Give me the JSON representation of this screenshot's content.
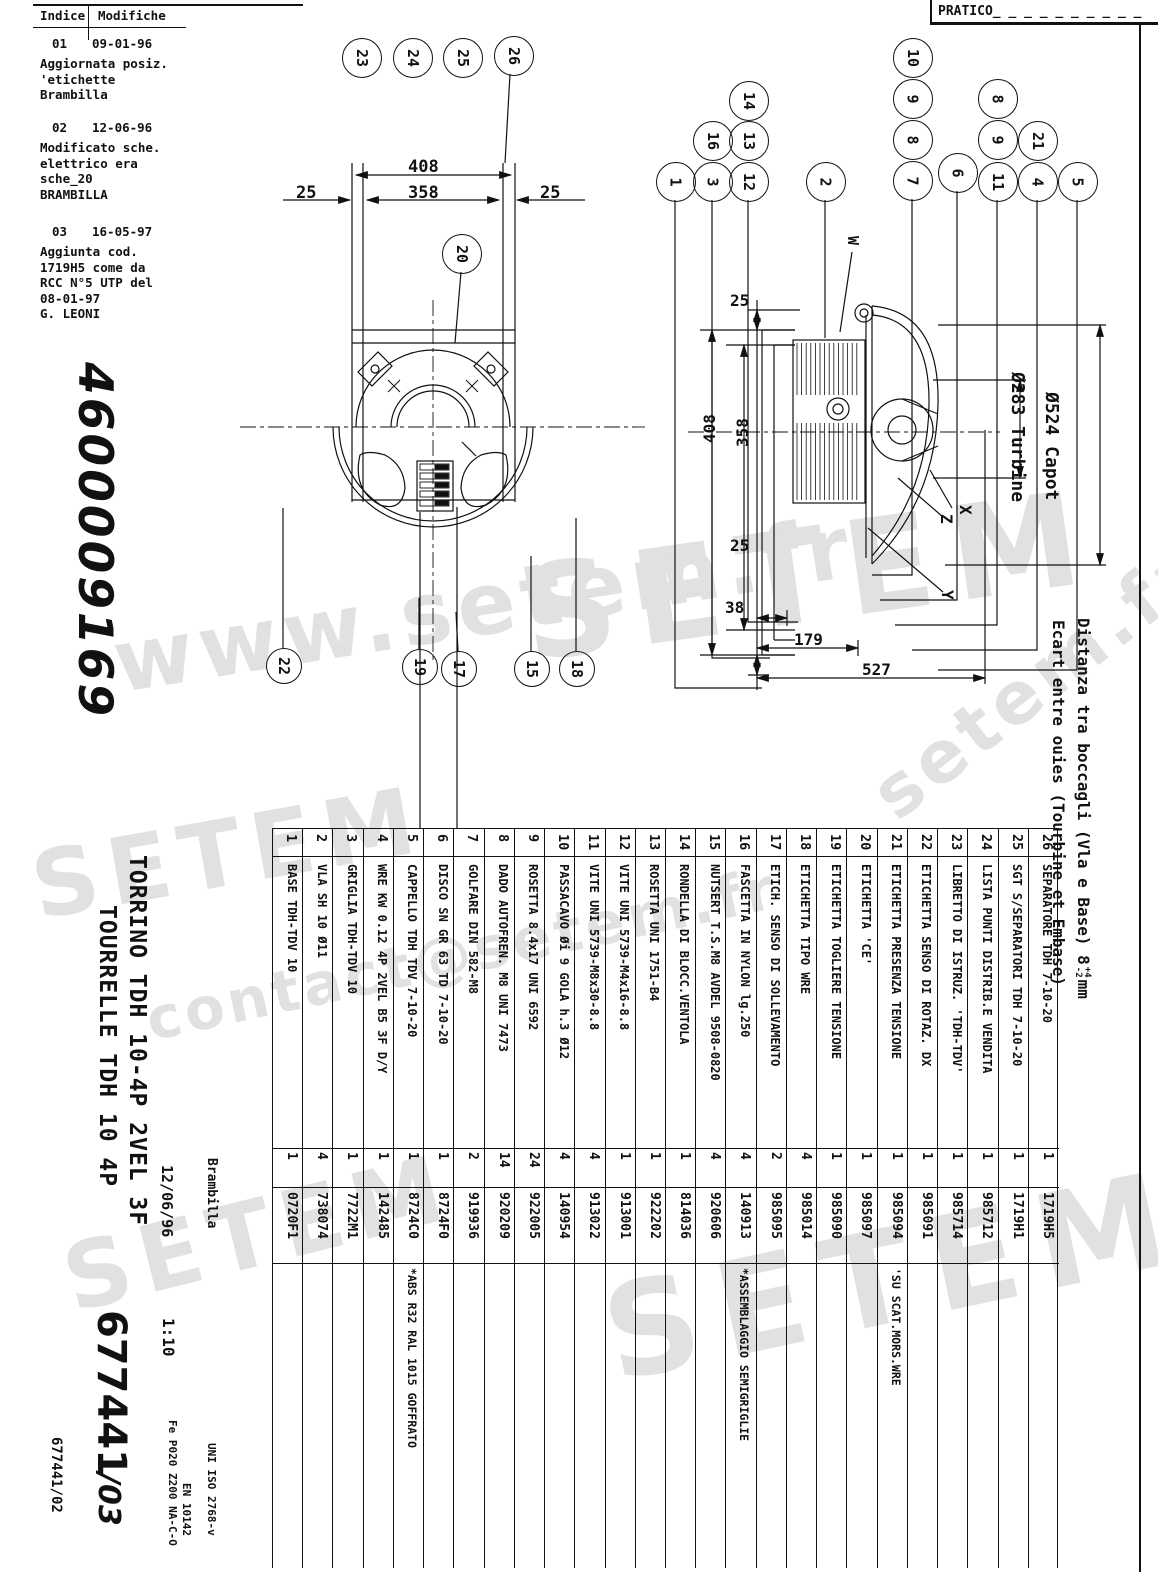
{
  "sheet": {
    "pratico_label": "PRATICO_ _ _ _ _ _ _ _ _ _",
    "drawing_number_large": "4600009169",
    "title_it": "TORRINO TDH 10-4P 2VEL 3F",
    "title_fr": "TOURRELLE TDH 10 4P",
    "date": "12/06/96",
    "author": "Brambilla",
    "scale": "1:10",
    "order_ref": "677441",
    "revision_suffix": "/03",
    "footer_ref": "677441/02",
    "standards": [
      "UNI ISO 2768-v",
      "EN 10142",
      "Fe P020 Z200 NA-C-O"
    ],
    "side_note_it": "Distanza tra boccagli (Vla e Base) 8",
    "side_note_tol_plus": "+4",
    "side_note_tol_minus": "-2",
    "side_note_unit": "mm",
    "side_note_fr": "Ecart entre ouies (Tourbine et Embase)"
  },
  "revisions": {
    "header_col1": "Indice",
    "header_col2": "Modifiche",
    "items": [
      {
        "index": "01",
        "date": "09-01-96",
        "lines": [
          "Aggiornata posiz.",
          "'etichette",
          "Brambilla"
        ]
      },
      {
        "index": "02",
        "date": "12-06-96",
        "lines": [
          "Modificato sche.",
          "elettrico era",
          "sche_20",
          "BRAMBILLA"
        ]
      },
      {
        "index": "03",
        "date": "16-05-97",
        "lines": [
          "Aggiunta cod.",
          "1719H5 come da",
          "RCC N°5 UTP del",
          "08-01-97",
          "   G. LEONI"
        ]
      }
    ]
  },
  "front_view": {
    "dims": {
      "overall": "408",
      "inner": "358",
      "left": "25",
      "right": "25"
    }
  },
  "side_view": {
    "dims": {
      "top": "25",
      "overall": "408",
      "inner": "358",
      "bottom": "25",
      "gap": "38",
      "offset": "179",
      "total": "527"
    },
    "labels": {
      "capot": "Ø524 Capot",
      "turbine": "Ø283 Turbine",
      "x": "X",
      "y": "Y",
      "z": "Z",
      "w": "W"
    }
  },
  "balloons": {
    "front_top": [
      "23",
      "24",
      "25",
      "26"
    ],
    "front_mid": "20",
    "front_bottom": [
      "22",
      "19",
      "17",
      "15",
      "18"
    ],
    "side_left": [
      "14",
      "16",
      "13",
      "1",
      "3",
      "12",
      "2"
    ],
    "side_right": [
      "10",
      "9",
      "8",
      "7",
      "6",
      "8",
      "9",
      "11",
      "21",
      "4",
      "5"
    ]
  },
  "parts_table": {
    "rows": [
      {
        "pos": "1",
        "desc": "BASE TDH-TDV 10",
        "qty": "1",
        "code": "0720F1",
        "note": ""
      },
      {
        "pos": "2",
        "desc": "VLA SH 10 Ø11",
        "qty": "4",
        "code": "738074",
        "note": ""
      },
      {
        "pos": "3",
        "desc": "GRIGLIA TDH-TDV 10",
        "qty": "1",
        "code": "7722M1",
        "note": ""
      },
      {
        "pos": "4",
        "desc": "WRE KW 0.12 4P 2VEL B5 3F D/Y",
        "qty": "1",
        "code": "142485",
        "note": ""
      },
      {
        "pos": "5",
        "desc": "CAPPELLO TDH TDV 7-10-20",
        "qty": "1",
        "code": "8724C0",
        "note": "*ABS R32 RAL 1015 GOFFRATO"
      },
      {
        "pos": "6",
        "desc": "DISCO SN GR 63 TD 7-10-20",
        "qty": "1",
        "code": "8724F0",
        "note": ""
      },
      {
        "pos": "7",
        "desc": "GOLFARE DIN 582-M8",
        "qty": "2",
        "code": "919936",
        "note": ""
      },
      {
        "pos": "8",
        "desc": "DADO AUTOFREN. M8 UNI 7473",
        "qty": "14",
        "code": "920209",
        "note": ""
      },
      {
        "pos": "9",
        "desc": "ROSETTA 8.4x17 UNI 6592",
        "qty": "24",
        "code": "922005",
        "note": ""
      },
      {
        "pos": "10",
        "desc": "PASSACAVO Øi 9 GOLA h.3 Ø12",
        "qty": "4",
        "code": "140954",
        "note": ""
      },
      {
        "pos": "11",
        "desc": "VITE UNI 5739-M8x30-8.8",
        "qty": "4",
        "code": "913022",
        "note": ""
      },
      {
        "pos": "12",
        "desc": "VITE UNI 5739-M4x16-8.8",
        "qty": "1",
        "code": "913001",
        "note": ""
      },
      {
        "pos": "13",
        "desc": "ROSETTA UNI 1751-B4",
        "qty": "1",
        "code": "922202",
        "note": ""
      },
      {
        "pos": "14",
        "desc": "RONDELLA DI BLOCC.VENTOLA",
        "qty": "1",
        "code": "814036",
        "note": ""
      },
      {
        "pos": "15",
        "desc": "NUTSERT T.S.M8 AVDEL 9508-0820",
        "qty": "4",
        "code": "920606",
        "note": ""
      },
      {
        "pos": "16",
        "desc": "FASCETTA IN NYLON lg.250",
        "qty": "4",
        "code": "140913",
        "note": "*ASSEMBLAGGIO SEMIGRIGLIE"
      },
      {
        "pos": "17",
        "desc": "ETICH. SENSO DI SOLLEVAMENTO",
        "qty": "2",
        "code": "985095",
        "note": ""
      },
      {
        "pos": "18",
        "desc": "ETICHETTA TIPO WRE",
        "qty": "4",
        "code": "985014",
        "note": ""
      },
      {
        "pos": "19",
        "desc": "ETICHETTA TOGLIERE TENSIONE",
        "qty": "1",
        "code": "985090",
        "note": ""
      },
      {
        "pos": "20",
        "desc": "ETICHETTA 'CE'",
        "qty": "1",
        "code": "985097",
        "note": ""
      },
      {
        "pos": "21",
        "desc": "ETICHETTA PRESENZA TENSIONE",
        "qty": "1",
        "code": "985094",
        "note": "'SU SCAT.MORS.WRE"
      },
      {
        "pos": "22",
        "desc": "ETICHETTA SENSO DI ROTAZ. DX",
        "qty": "1",
        "code": "985091",
        "note": ""
      },
      {
        "pos": "23",
        "desc": "LIBRETTO DI ISTRUZ. 'TDH-TDV'",
        "qty": "1",
        "code": "985714",
        "note": ""
      },
      {
        "pos": "24",
        "desc": "LISTA PUNTI DISTRIB.E VENDITA",
        "qty": "1",
        "code": "985712",
        "note": ""
      },
      {
        "pos": "25",
        "desc": "SGT S/SEPARATORI TDH 7-10-20",
        "qty": "1",
        "code": "1719H1",
        "note": ""
      },
      {
        "pos": "26",
        "desc": "SEPARATORE TDH 7-10-20",
        "qty": "1",
        "code": "1719H5",
        "note": ""
      }
    ]
  },
  "watermarks": [
    {
      "text": "SETEM"
    },
    {
      "text": "www.setem.fr"
    },
    {
      "text": "SETEM"
    },
    {
      "text": "contact@setem.fr"
    },
    {
      "text": "SETEM"
    },
    {
      "text": "SETEM"
    },
    {
      "text": "setem.fr"
    }
  ],
  "colors": {
    "line": "#111111",
    "watermark": "#e1e1e1",
    "paper": "#ffffff"
  }
}
